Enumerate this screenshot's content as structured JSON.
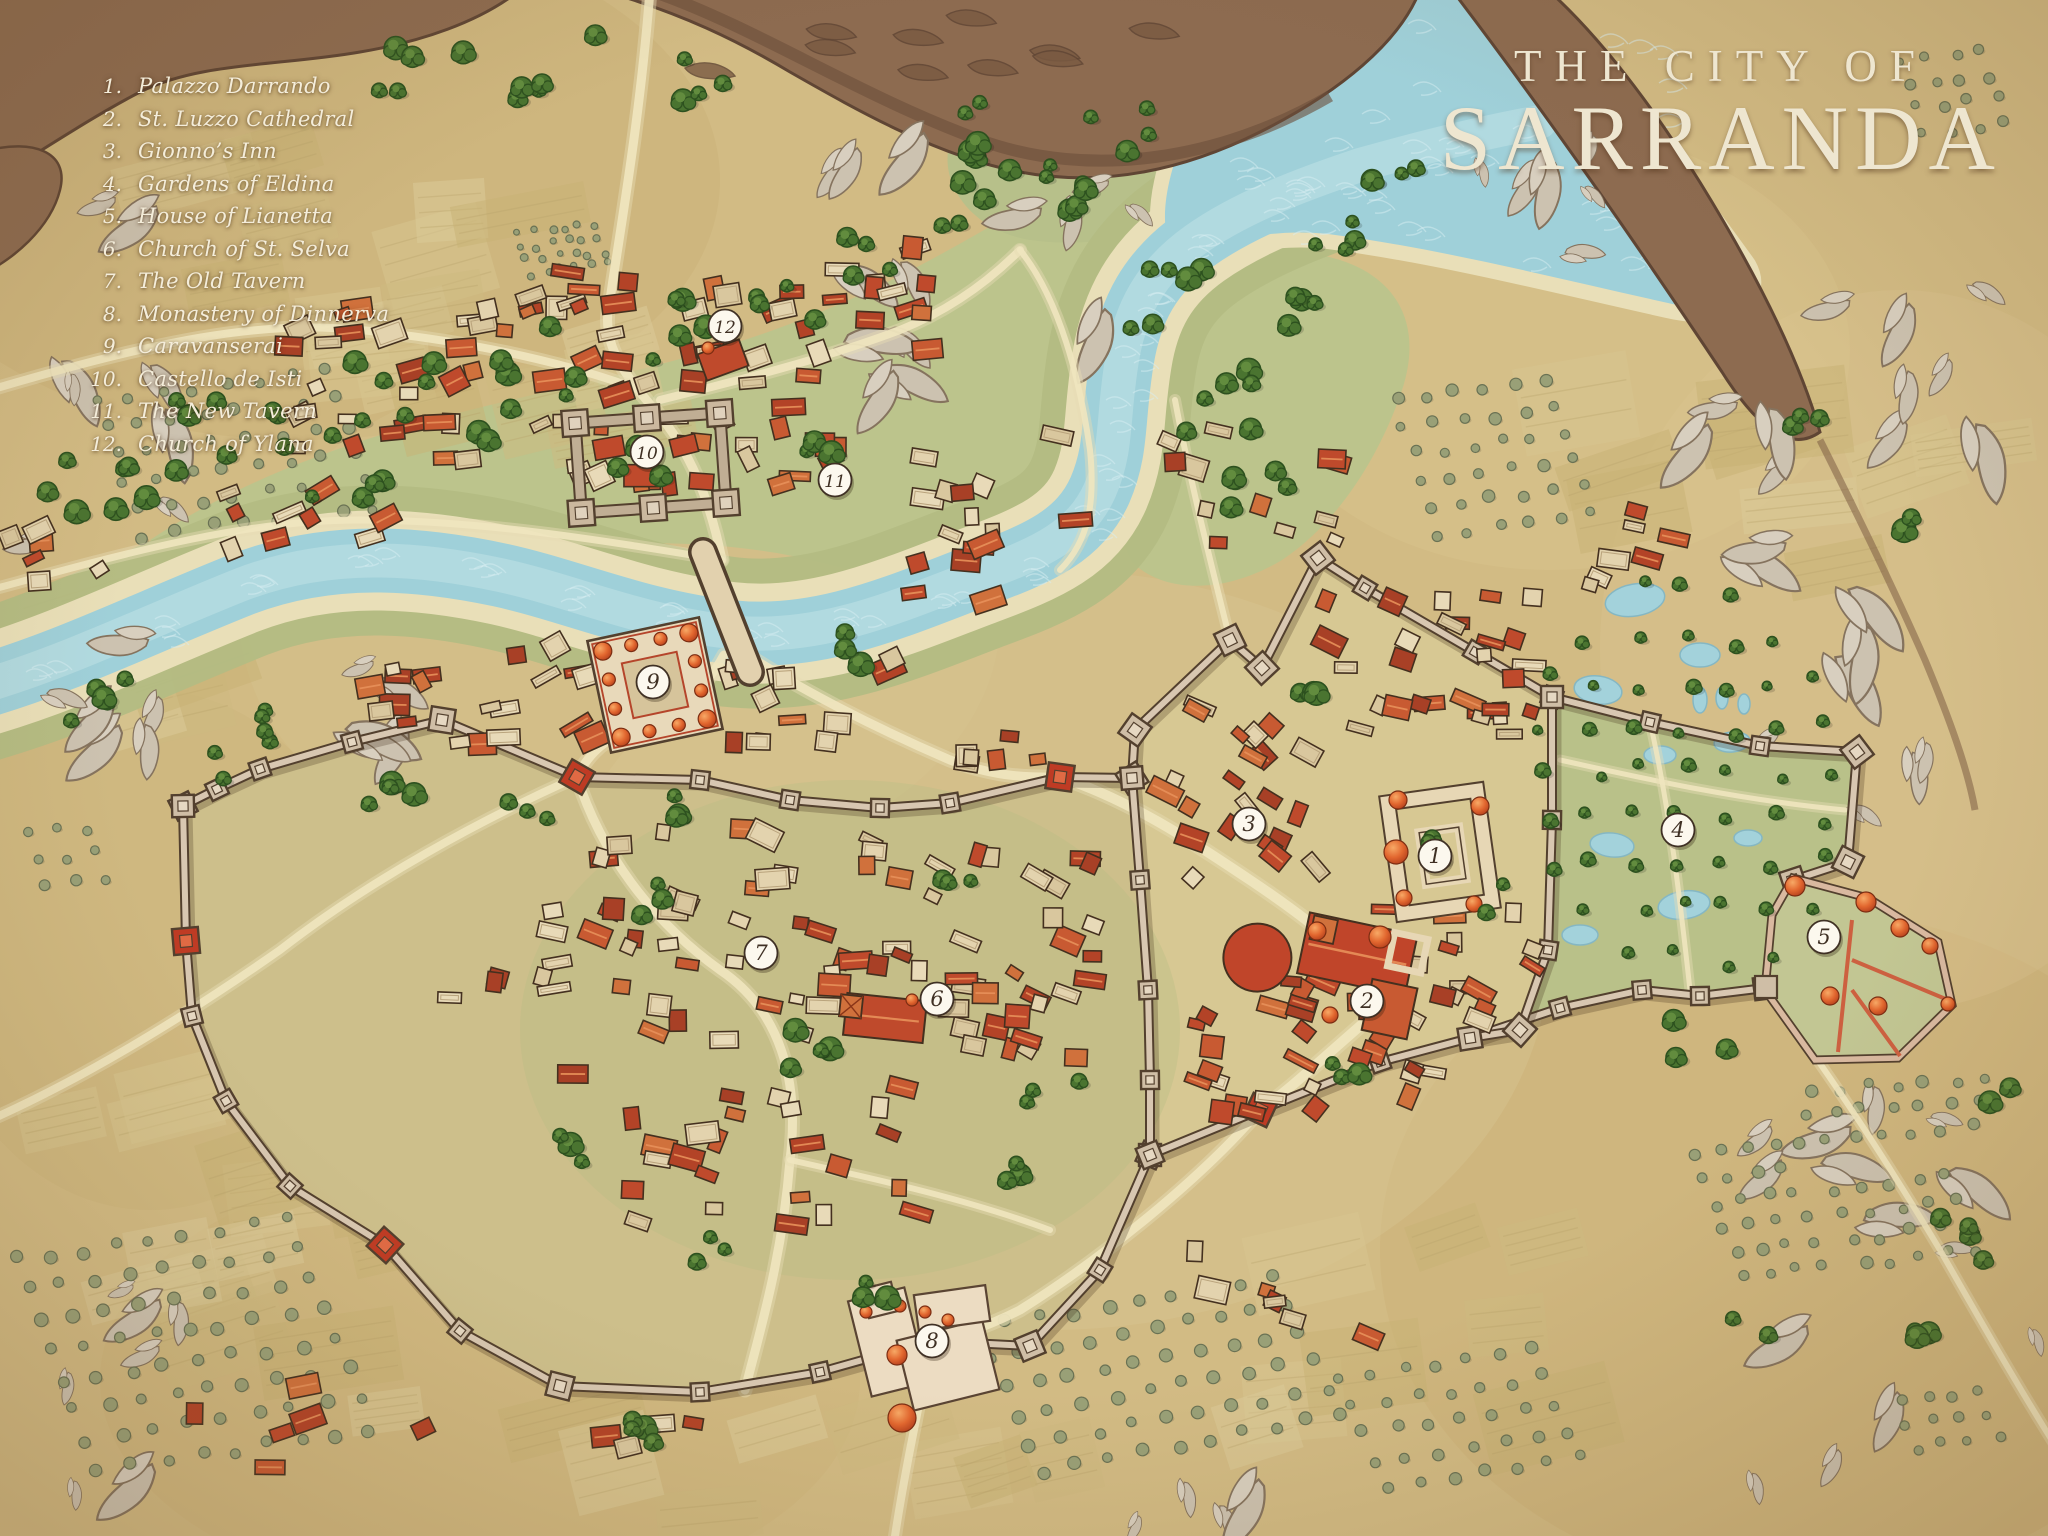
{
  "title": {
    "line1": "THE CITY OF",
    "line2": "SARRANDA"
  },
  "legend": {
    "items": [
      {
        "num": "1.",
        "label": "Palazzo Darrando"
      },
      {
        "num": "2.",
        "label": "St. Luzzo Cathedral"
      },
      {
        "num": "3.",
        "label": "Gionno’s Inn"
      },
      {
        "num": "4.",
        "label": "Gardens of Eldina"
      },
      {
        "num": "5.",
        "label": "House of Lianetta"
      },
      {
        "num": "6.",
        "label": "Church of St. Selva"
      },
      {
        "num": "7.",
        "label": "The Old Tavern"
      },
      {
        "num": "8.",
        "label": "Monastery of Dinnerva"
      },
      {
        "num": "9.",
        "label": "Caravanserai"
      },
      {
        "num": "10.",
        "label": "Castello de Isti"
      },
      {
        "num": "11.",
        "label": "The New Tavern"
      },
      {
        "num": "12.",
        "label": "Church of Ylana"
      }
    ]
  },
  "markers": [
    {
      "num": "1",
      "x": 1435,
      "y": 856
    },
    {
      "num": "2",
      "x": 1367,
      "y": 1001
    },
    {
      "num": "3",
      "x": 1249,
      "y": 824
    },
    {
      "num": "4",
      "x": 1678,
      "y": 830
    },
    {
      "num": "5",
      "x": 1824,
      "y": 937
    },
    {
      "num": "6",
      "x": 937,
      "y": 999
    },
    {
      "num": "7",
      "x": 761,
      "y": 953
    },
    {
      "num": "8",
      "x": 932,
      "y": 1341
    },
    {
      "num": "9",
      "x": 653,
      "y": 682
    },
    {
      "num": "10",
      "x": 647,
      "y": 452
    },
    {
      "num": "11",
      "x": 835,
      "y": 480
    },
    {
      "num": "12",
      "x": 725,
      "y": 326
    }
  ],
  "palette": {
    "parchment": "#d2bb84",
    "water": "#9fd0d9",
    "building_red": "#bf4a2c",
    "wall": "#d8c7b1",
    "tree_green": "#4a7430",
    "marker_fill": "#fcf8ee",
    "marker_ink": "#3f3024",
    "legend_ink": "#f4edda",
    "title_ink": "#eee6d0"
  }
}
